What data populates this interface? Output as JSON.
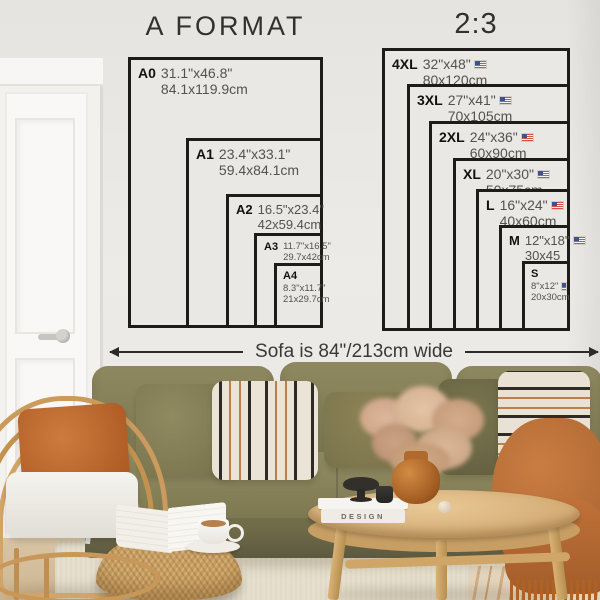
{
  "left_chart": {
    "title": "A FORMAT",
    "sizes": [
      {
        "name": "A0",
        "inches": "31.1\"x46.8\"",
        "cm": "84.1x119.9cm"
      },
      {
        "name": "A1",
        "inches": "23.4\"x33.1\"",
        "cm": "59.4x84.1cm"
      },
      {
        "name": "A2",
        "inches": "16.5\"x23.4\"",
        "cm": "42x59.4cm"
      },
      {
        "name": "A3",
        "inches": "11.7\"x16.5\"",
        "cm": "29.7x42cm"
      },
      {
        "name": "A4",
        "inches": "8.3\"x11.7\"",
        "cm": "21x29.7cm"
      }
    ]
  },
  "right_chart": {
    "title": "2:3",
    "flag_icon": "us-flag-icon",
    "sizes": [
      {
        "name": "4XL",
        "inches": "32\"x48\"",
        "cm": "80x120cm"
      },
      {
        "name": "3XL",
        "inches": "27\"x41\"",
        "cm": "70x105cm"
      },
      {
        "name": "2XL",
        "inches": "24\"x36\"",
        "cm": "60x90cm"
      },
      {
        "name": "XL",
        "inches": "20\"x30\"",
        "cm": "50x75cm"
      },
      {
        "name": "L",
        "inches": "16\"x24\"",
        "cm": "40x60cm"
      },
      {
        "name": "M",
        "inches": "12\"x18\"",
        "cm": "30x45"
      },
      {
        "name": "S",
        "inches": "8\"x12\"",
        "cm": "20x30cm"
      }
    ]
  },
  "measure": {
    "label": "Sofa is 84\"/213cm wide"
  },
  "scene": {
    "book_title": "DESIGN"
  },
  "colors": {
    "wall": "#e9e7e4",
    "chart_line": "#1d1c19",
    "dim_text": "#55524d",
    "sofa_olive": "#7e7852",
    "pillow_rust": "#c06b34",
    "throw_rust": "#b86e38",
    "rattan": "#c9995c",
    "table_wood": "#d3ab74",
    "rug": "#e6dfcd"
  }
}
